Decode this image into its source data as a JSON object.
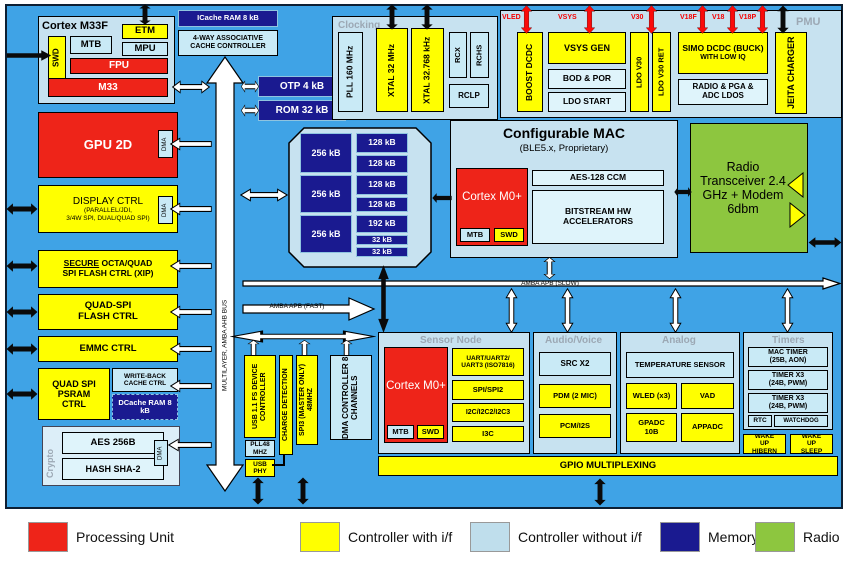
{
  "colors": {
    "background_blue": "#3FA3E6",
    "processing_unit_red": "#EE2419",
    "controller_yellow": "#FFFF00",
    "controller_no_if_cyan": "#C9EAF6",
    "memory_navy": "#1A1A90",
    "radio_green": "#8DC63F",
    "rail_label_red": "#F50000"
  },
  "buses": {
    "ahb": "MULTILAYER, AMBA AHB BUS",
    "slow": "AMBA APB (SLOW)",
    "fast": "AMBA APB (FAST)"
  },
  "m33f": {
    "title": "Cortex M33F",
    "etm": "ETM",
    "swd": "SWD",
    "mtb": "MTB",
    "mpu": "MPU",
    "fpu": "FPU",
    "core": "M33"
  },
  "cache": {
    "icache": "ICache RAM 8 kB",
    "ctrl": "4-WAY ASSOCIATIVE CACHE CONTROLLER",
    "otp": "OTP 4 kB",
    "rom": "ROM 32 kB"
  },
  "clocking": {
    "title": "Clocking",
    "pll": "PLL 160 MHz",
    "xtal_m": "XTAL 32 MHz",
    "xtal_k": "XTAL 32.768 kHz",
    "rcx": "RCX",
    "rchs": "RCHS",
    "rclp": "RCLP"
  },
  "pmu": {
    "title": "PMU",
    "rails": [
      "VLED",
      "VSYS",
      "V30",
      "V18F",
      "V18",
      "V18P"
    ],
    "boost": "BOOST DCDC",
    "vsys_gen": "VSYS GEN",
    "bod_por": "BOD & POR",
    "ldo_start": "LDO START",
    "ldo_v30": "LDO V30",
    "ldo_v30_ret": "LDO V30 RET",
    "simo_l1": "SIMO DCDC (BUCK)",
    "simo_l2": "WITH LOW IQ",
    "radio_ldos": "RADIO & PGA & ADC LDOS",
    "jeita": "JEITA CHARGER"
  },
  "left": {
    "gpu": "GPU 2D",
    "dma": "DMA",
    "display_title": "DISPLAY CTRL",
    "display_sub1": "(PARALLEL/JDI,",
    "display_sub2": "3/4W SPI, DUAL/QUAD SPI)",
    "secure_word": "SECURE",
    "secure_rest": " OCTA/QUAD",
    "secure_l2": "SPI FLASH CTRL (XIP)",
    "quadspi_l1": "QUAD-SPI",
    "quadspi_l2": "FLASH CTRL",
    "emmc": "EMMC CTRL",
    "psram": "QUAD SPI PSRAM CTRL",
    "writeback": "WRITE-BACK CACHE CTRL",
    "dcache": "DCache RAM 8 kB"
  },
  "crypto": {
    "title": "Crypto",
    "aes": "AES 256B",
    "hash": "HASH SHA-2",
    "dma": "DMA"
  },
  "memory": {
    "large": [
      "256 kB",
      "256 kB",
      "256 kB"
    ],
    "small": [
      "128 kB",
      "128 kB",
      "128 kB",
      "128 kB",
      "192 kB",
      "32 kB",
      "32 kB"
    ]
  },
  "mac": {
    "title": "Configurable MAC",
    "subtitle": "(BLE5.x, Proprietary)",
    "core": "Cortex M0+",
    "mtb": "MTB",
    "swd": "SWD",
    "aes": "AES-128 CCM",
    "bitstream": "BITSTREAM HW ACCELERATORS"
  },
  "radio": {
    "text": "Radio Transceiver 2.4 GHz + Modem 6dbm"
  },
  "mid": {
    "usb": "USB 1.1 FS DEVICE CONTROLLER",
    "pll48": "PLL48 MHZ",
    "usb_phy": "USB PHY",
    "charge": "CHARGE DETECTION",
    "spi3": "SPI3 (MASTER ONLY) 48MHZ",
    "dma_ctrl": "DMA CONTROLLER 8 CHANNELS"
  },
  "sensor": {
    "title": "Sensor Node",
    "core": "Cortex M0+",
    "mtb": "MTB",
    "swd": "SWD",
    "items": [
      "UART/UART2/ UART3 (ISO7816)",
      "SPI/SPI2",
      "I2C/I2C2/I2C3",
      "I3C"
    ]
  },
  "audio": {
    "title": "Audio/Voice",
    "items": [
      "SRC X2",
      "PDM (2 MIC)",
      "PCM/I2S"
    ]
  },
  "analog": {
    "title": "Analog",
    "temp": "TEMPERATURE SENSOR",
    "wled": "WLED (x3)",
    "vad": "VAD",
    "gpadc": "GPADC 10B",
    "appadc": "APPADC"
  },
  "timers": {
    "title": "Timers",
    "items": [
      "MAC TIMER (25B, AON)",
      "TIMER X3 (24B, PWM)",
      "TIMER X3 (24B, PWM)"
    ],
    "rtc": "RTC",
    "watchdog": "WATCHDOG"
  },
  "wake": {
    "hibern": "WAKE UP HIBERN",
    "sleep": "WAKE UP SLEEP"
  },
  "gpio": "GPIO MULTIPLEXING",
  "legend": {
    "items": [
      {
        "label": "Processing Unit",
        "color": "#EE2419"
      },
      {
        "label": "Controller with i/f",
        "color": "#FFFF00"
      },
      {
        "label": "Controller without i/f",
        "color": "#BFDEEC"
      },
      {
        "label": "Memory Cell",
        "color": "#1A1A90"
      },
      {
        "label": "Radio",
        "color": "#8DC63F"
      }
    ]
  }
}
